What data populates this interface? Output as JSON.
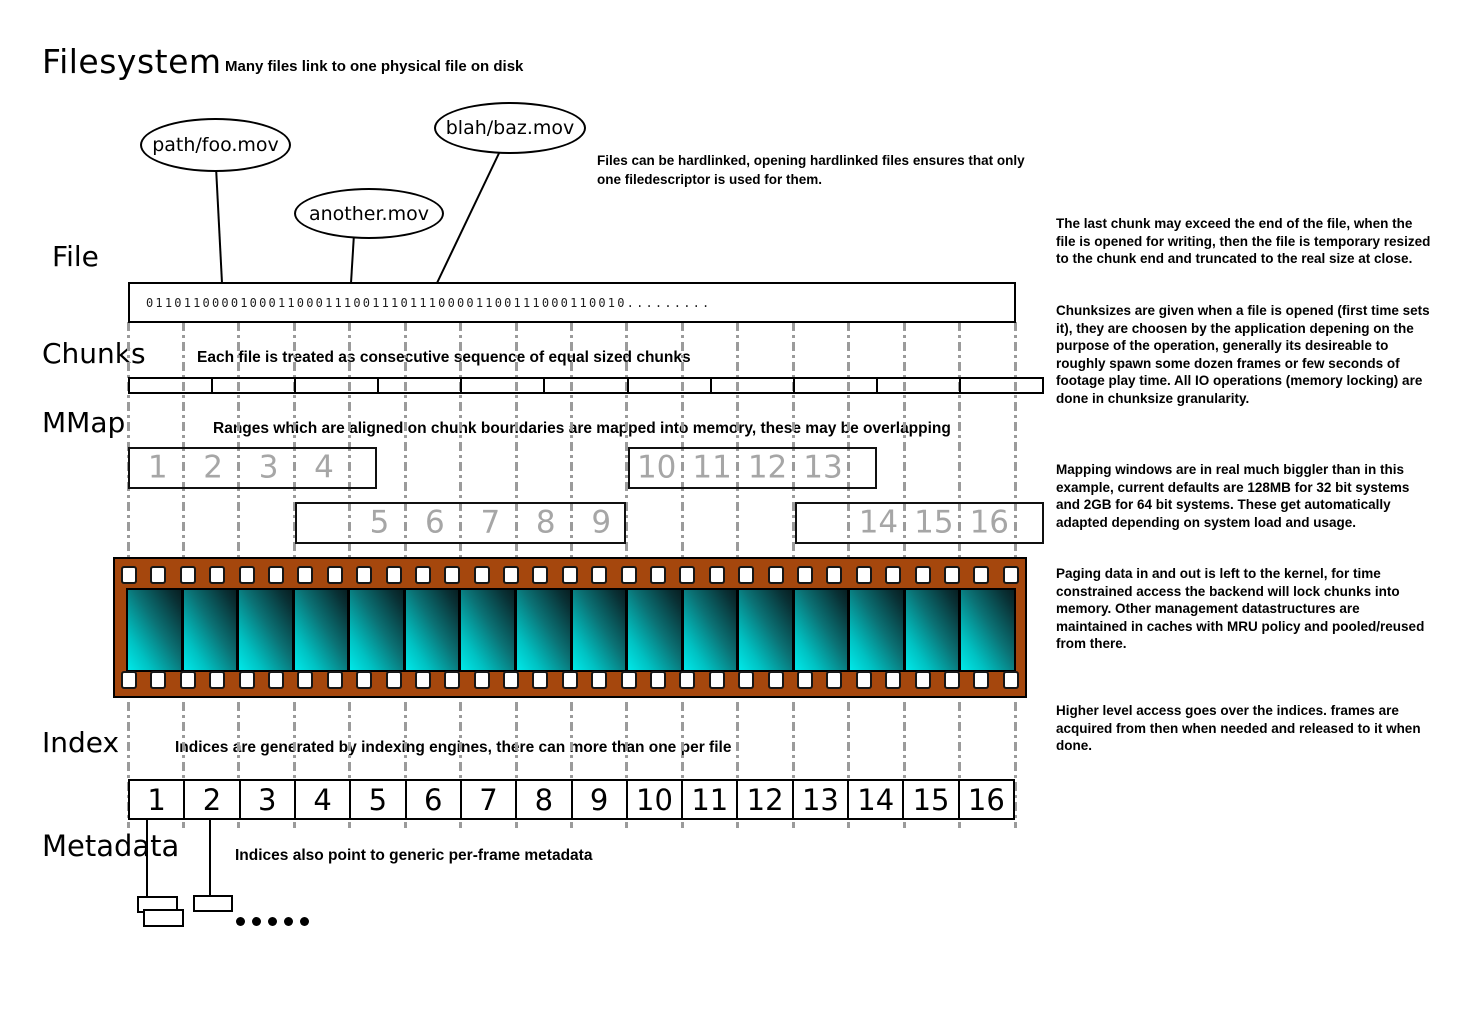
{
  "title": "Filesystem",
  "subtitle": "Many files link to one physical file on disk",
  "hardlink_note": "Files can be hardlinked, opening hardlinked files ensures that only one filedescriptor is used for them.",
  "file_links": [
    {
      "text": "path/foo.mov"
    },
    {
      "text": "another.mov"
    },
    {
      "text": "blah/baz.mov"
    }
  ],
  "file": {
    "label": "File",
    "binary": "011011000010001100011100111011100001100111000110010........."
  },
  "chunks": {
    "label": "Chunks",
    "caption": "Each file is treated as consecutive sequence of equal sized chunks",
    "segment_count": 11
  },
  "mmap": {
    "label": "MMap",
    "caption": "Ranges which are aligned on chunk boundaries are mapped into memory, these may be overlapping",
    "windows": [
      {
        "frames": [
          "1",
          "2",
          "3",
          "4"
        ]
      },
      {
        "frames": [
          "10",
          "11",
          "12",
          "13"
        ]
      },
      {
        "frames": [
          "5",
          "6",
          "7",
          "8",
          "9"
        ]
      },
      {
        "frames": [
          "14",
          "15",
          "16"
        ]
      }
    ]
  },
  "filmstrip": {
    "frame_count": 16,
    "sprockets_per_row": 31
  },
  "index": {
    "label": "Index",
    "caption": "Indices are generated by indexing engines, there can more than one per file",
    "cells": [
      "1",
      "2",
      "3",
      "4",
      "5",
      "6",
      "7",
      "8",
      "9",
      "10",
      "11",
      "12",
      "13",
      "14",
      "15",
      "16"
    ]
  },
  "metadata": {
    "label": "Metadata",
    "caption": "Indices also point to generic per-frame metadata",
    "dot_count": 5
  },
  "notes": [
    "The last chunk may exceed the end of the file, when the file is opened for writing, then the file is temporary resized to the chunk end and truncated to the real size at close.",
    "Chunksizes are given when a file is opened (first time sets it), they are choosen by the application depening on the purpose of the operation, generally its desireable to roughly spawn some dozen frames or few seconds of footage play time. All IO operations (memory locking) are done in chunksize granularity.",
    "Mapping windows are in real much biggler than in this example, current defaults are 128MB for 32 bit systems and 2GB for 64 bit systems. These get automatically adapted depending on system load and usage.",
    "Paging data in and out is left to the kernel, for time constrained access the backend will lock chunks into memory. Other management datastructures are maintained in caches with MRU policy and pooled/reused from there.",
    "Higher level access goes over the indices. frames are acquired from then when needed and released to it when done."
  ],
  "colors": {
    "film_border": "#a5470d",
    "frame_bright": "#00e9e9",
    "frame_dark": "#081f22",
    "gridline": "#9b9b9b",
    "mmap_number": "#a6a6a6"
  }
}
